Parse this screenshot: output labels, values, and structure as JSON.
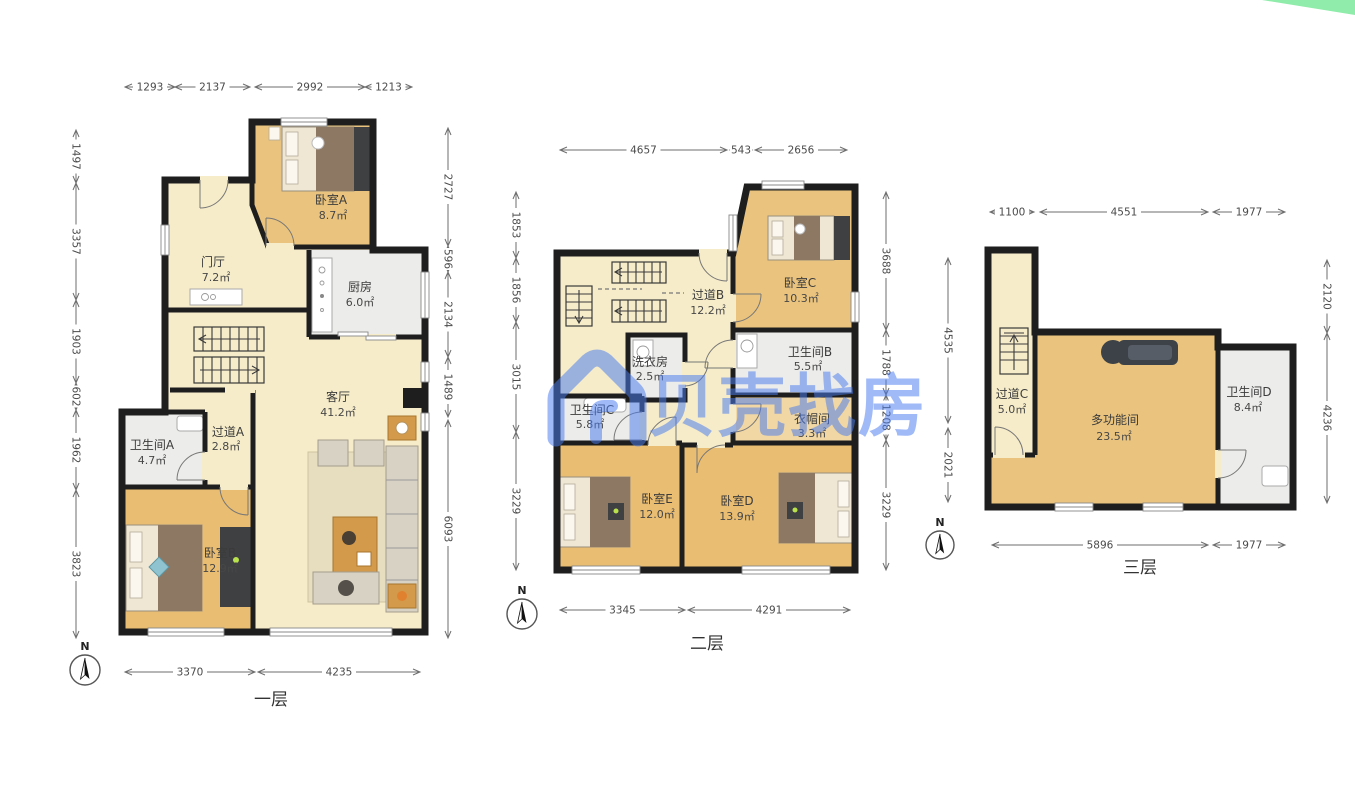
{
  "watermark": {
    "brand": "贝壳找房",
    "color": "#4a7cf0"
  },
  "corner_ribbon": {
    "color": "#90ecaa"
  },
  "floors": [
    {
      "title": "一层",
      "compass": "N",
      "dims_top": [
        "1293",
        "2137",
        "2992",
        "1213"
      ],
      "dims_left": [
        "1497",
        "3357",
        "1903",
        "602",
        "1962",
        "3823"
      ],
      "dims_right": [
        "2727",
        "596",
        "2134",
        "1489",
        "6093"
      ],
      "dims_bottom": [
        "3370",
        "4235"
      ],
      "rooms": [
        {
          "name": "卧室A",
          "area": "8.7㎡"
        },
        {
          "name": "门厅",
          "area": "7.2㎡"
        },
        {
          "name": "厨房",
          "area": "6.0㎡"
        },
        {
          "name": "客厅",
          "area": "41.2㎡"
        },
        {
          "name": "卫生间A",
          "area": "4.7㎡"
        },
        {
          "name": "过道A",
          "area": "2.8㎡"
        },
        {
          "name": "卧室B",
          "area": "12.9㎡"
        }
      ]
    },
    {
      "title": "二层",
      "compass": "N",
      "dims_top": [
        "4657",
        "543",
        "2656"
      ],
      "dims_left": [
        "1853",
        "1856",
        "3015",
        "3229"
      ],
      "dims_right": [
        "3688",
        "1788",
        "1208",
        "3229"
      ],
      "dims_bottom": [
        "3345",
        "4291"
      ],
      "rooms": [
        {
          "name": "过道B",
          "area": "12.2㎡"
        },
        {
          "name": "卧室C",
          "area": "10.3㎡"
        },
        {
          "name": "洗衣房",
          "area": "2.5㎡"
        },
        {
          "name": "卫生间B",
          "area": "5.5㎡"
        },
        {
          "name": "卫生间C",
          "area": "5.8㎡"
        },
        {
          "name": "衣帽间",
          "area": "3.3㎡"
        },
        {
          "name": "卧室E",
          "area": "12.0㎡"
        },
        {
          "name": "卧室D",
          "area": "13.9㎡"
        }
      ]
    },
    {
      "title": "三层",
      "compass": "N",
      "dims_top": [
        "1100",
        "4551",
        "1977"
      ],
      "dims_left": [
        "4535",
        "2021"
      ],
      "dims_right": [
        "2120",
        "4236"
      ],
      "dims_bottom": [
        "5896",
        "1977"
      ],
      "rooms": [
        {
          "name": "过道C",
          "area": "5.0㎡"
        },
        {
          "name": "多功能间",
          "area": "23.5㎡"
        },
        {
          "name": "卫生间D",
          "area": "8.4㎡"
        }
      ]
    }
  ]
}
